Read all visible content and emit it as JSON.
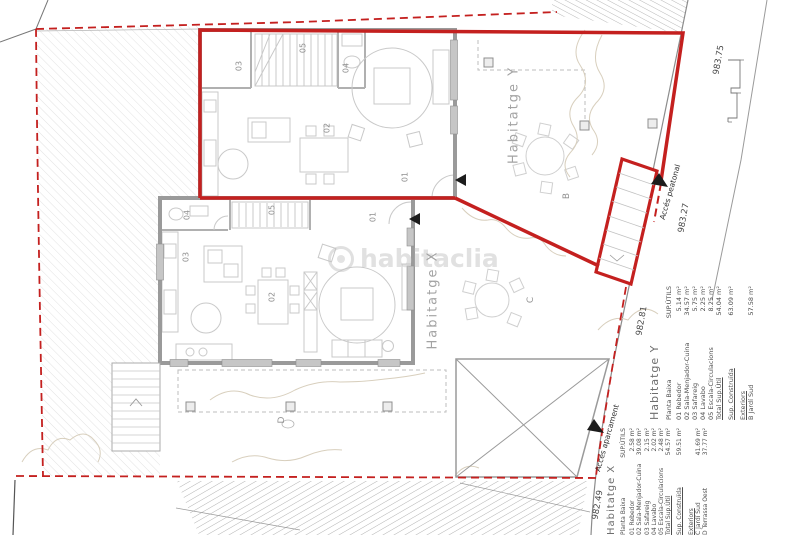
{
  "meta": {
    "watermark": "habitaclia"
  },
  "colors": {
    "accent_red": "#c4201f",
    "wall_gray": "#9a9a9a",
    "furniture_gray": "#c9c9c9"
  },
  "labels": {
    "unit_y_title": "Habitatge Y",
    "unit_x_title": "Habitatge X",
    "garden_b": "B",
    "garden_c": "C",
    "terrace_d": "D",
    "access_pedestrian": "Accés peatonal",
    "access_parking": "Accés aparcament",
    "elev_1": "983.75",
    "elev_2": "983.27",
    "elev_3": "982.81",
    "elev_4": "982.49",
    "rooms": {
      "r01": "01",
      "r02": "02",
      "r03": "03",
      "r04": "04",
      "r05": "05"
    }
  },
  "tables": {
    "y": {
      "title": "Habitatge Y",
      "floor_header": "Planta Baixa",
      "sup_header": "SUP.ÚTILS",
      "rows": [
        {
          "name": "01 Rebedor",
          "value": "5.14 m²"
        },
        {
          "name": "02 Sala-Menjador-Cuina",
          "value": "34.57 m²"
        },
        {
          "name": "03 Safareig",
          "value": "5.75 m²"
        },
        {
          "name": "04 Lavabo",
          "value": "2.25 m²"
        },
        {
          "name": "05 Escala-Circulacions",
          "value": "8.25 m²"
        }
      ],
      "total_label": "Total Sup.Útil",
      "total_value": "54.04 m²",
      "built_label": "Sup. Construïda",
      "built_value": "63.09 m²",
      "ext_header": "Exteriors",
      "ext_rows": [
        {
          "name": "B Jardí Sud",
          "value": "57.58 m²"
        }
      ]
    },
    "x": {
      "title": "Habitatge X",
      "floor_header": "Planta Baixa",
      "sup_header": "SUP.ÚTILS",
      "rows": [
        {
          "name": "01 Rebedor",
          "value": "2.58 m²"
        },
        {
          "name": "02 Sala-Menjador-Cuina",
          "value": "39.08 m²"
        },
        {
          "name": "03 Safareig",
          "value": "2.15 m²"
        },
        {
          "name": "04 Lavabo",
          "value": "2.02 m²"
        },
        {
          "name": "05 Escala-Circulacions",
          "value": "2.48 m²"
        }
      ],
      "total_label": "Total Sup.Útil",
      "total_value": "54.57 m²",
      "built_label": "Sup. Construïda",
      "built_value": "59.51 m²",
      "ext_header": "Exteriors",
      "ext_rows": [
        {
          "name": "C Jardí Sud",
          "value": "41.69 m²"
        },
        {
          "name": "D Terrassa Oest",
          "value": "37.77 m²"
        }
      ]
    }
  }
}
